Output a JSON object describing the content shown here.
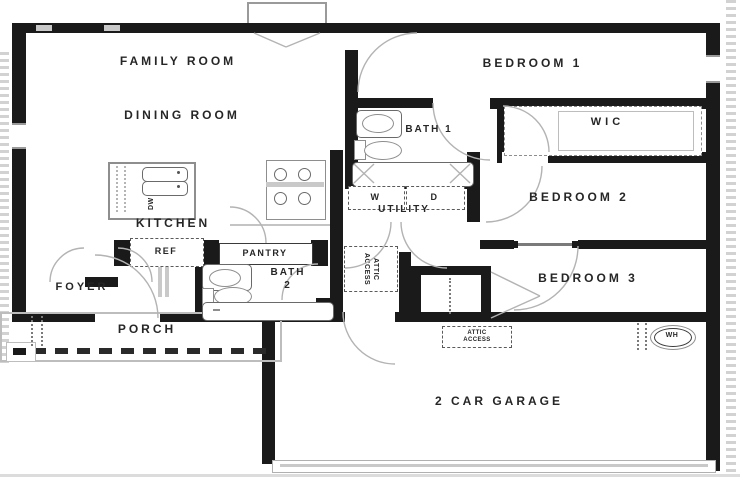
{
  "plan": {
    "title": "single-story house floor plan",
    "rooms": {
      "family_room": "FAMILY ROOM",
      "dining_room": "DINING ROOM",
      "kitchen": "KITCHEN",
      "bedroom_1": "BEDROOM 1",
      "bath_1": "BATH 1",
      "wic": "WIC",
      "bedroom_2": "BEDROOM 2",
      "bedroom_3": "BEDROOM 3",
      "utility": "UTILITY",
      "foyer": "FOYER",
      "porch": "PORCH",
      "pantry": "PANTRY",
      "bath_2_line1": "BATH",
      "bath_2_line2": "2",
      "garage": "2 CAR GARAGE"
    },
    "appliances": {
      "washer": "W",
      "dryer": "D",
      "refrigerator": "REF",
      "dishwasher": "DW",
      "water_heater": "WH"
    },
    "annotations": {
      "attic_hall_line1": "ATTIC",
      "attic_hall_line2": "ACCESS",
      "attic_garage_line1": "ATTIC",
      "attic_garage_line2": "ACCESS"
    },
    "colors": {
      "wall": "#1a1a1a",
      "fixture_line": "#9a9a9a",
      "label": "#262626",
      "background": "#ffffff"
    }
  }
}
